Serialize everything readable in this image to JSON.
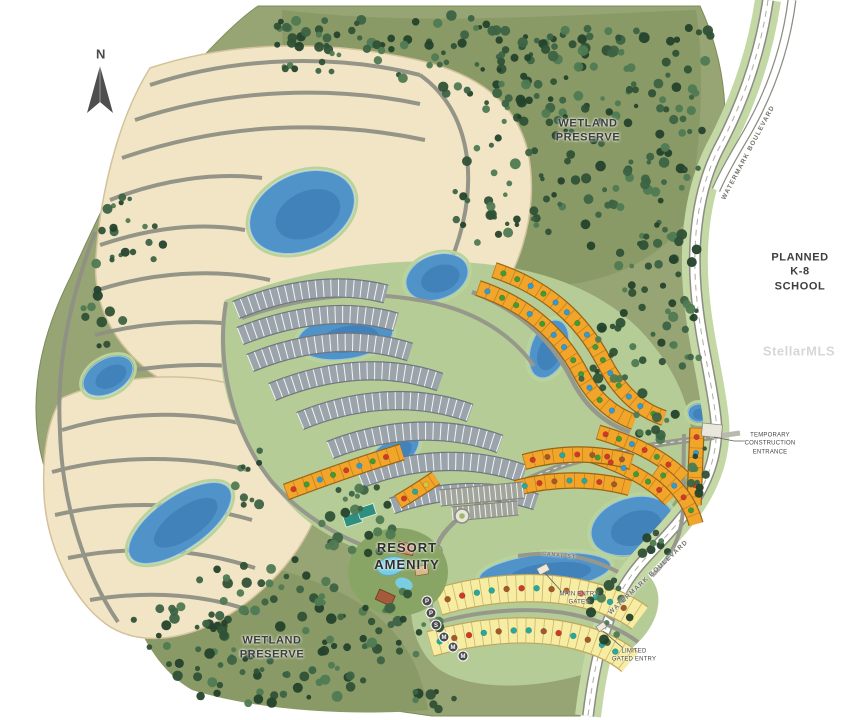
{
  "labels": {
    "compass": "N",
    "wetland_top": "WETLAND\nPRESERVE",
    "wetland_bottom": "WETLAND\nPRESERVE",
    "planned_school": "PLANNED\nK-8 SCHOOL",
    "resort_amenity": "RESORT\nAMENITY",
    "temp_construction_entrance": "TEMPORARY\nCONSTRUCTION\nENTRANCE",
    "main_entry_gates": "MAIN ENTRY\nGATES",
    "limited_gated_entry": "LIMITED\nGATED ENTRY",
    "watermark_blvd_top": "WATERMARK BOULEVARD",
    "watermark_blvd_bottom": "WATERMARK BOULEVARD",
    "canal_st": "CANAL ST.",
    "stellar_watermark": "StellarMLS"
  },
  "palette": {
    "olive": "#97a474",
    "olive_dark": "#8a9a66",
    "green_light": "#b5cc96",
    "verge": "#c3d8a4",
    "beige": "#f2e5c6",
    "beige_edge": "#d3c29b",
    "street": "#8f9184",
    "road": "#96988c",
    "road_casing": "#8c8c82",
    "road_white": "#ffffff",
    "lake": "#4f93c9",
    "lake_deep": "#2f6ea6",
    "lake_edge": "#9fc6e4",
    "shore": "#b9d49a",
    "lot_gray": "#9ba3ab",
    "lot_gray_edge": "#6f767e",
    "lot_orange": "#f2a52b",
    "lot_orange_edge": "#9a6415",
    "lot_yellow": "#f6eda2",
    "lot_yellow_edge": "#c0a55e",
    "parking": "#a2a59c",
    "parking_edge": "#85887f",
    "dot_green": "#3f9c35",
    "dot_blue": "#2e9bd6",
    "dot_red": "#cf3a28",
    "dot_teal": "#27a89e",
    "dot_brown": "#a3582a",
    "dot_yellow": "#d9c63a",
    "trees": [
      "#24422c",
      "#2f5136",
      "#3c6344",
      "#4f7a52"
    ],
    "text": "#3e3e3e"
  },
  "map": {
    "lakes": [
      {
        "cx": 302,
        "cy": 212,
        "rx": 55,
        "ry": 38,
        "rot": -25
      },
      {
        "cx": 345,
        "cy": 337,
        "rx": 48,
        "ry": 22,
        "rot": -8
      },
      {
        "cx": 108,
        "cy": 376,
        "rx": 27,
        "ry": 17,
        "rot": -30
      },
      {
        "cx": 180,
        "cy": 523,
        "rx": 60,
        "ry": 26,
        "rot": -35
      },
      {
        "cx": 392,
        "cy": 456,
        "rx": 32,
        "ry": 15,
        "rot": -38
      },
      {
        "cx": 549,
        "cy": 349,
        "rx": 18,
        "ry": 30,
        "rot": 20
      },
      {
        "cx": 632,
        "cy": 526,
        "rx": 42,
        "ry": 28,
        "rot": -18
      },
      {
        "cx": 545,
        "cy": 572,
        "rx": 66,
        "ry": 18,
        "rot": -6
      },
      {
        "cx": 699,
        "cy": 413,
        "rx": 11,
        "ry": 9,
        "rot": 0
      },
      {
        "cx": 437,
        "cy": 277,
        "rx": 32,
        "ry": 22,
        "rot": -20
      }
    ],
    "strips": [
      {
        "name": "gray-row-1",
        "d": "M 236 310 C 290 288 340 282 386 294",
        "w": 17,
        "fill": "lot_gray",
        "edge": "lot_gray_edge",
        "div": {
          "c": "road_white",
          "dash": "1 6.5",
          "op": 0.9
        }
      },
      {
        "name": "gray-row-2",
        "d": "M 240 336 C 296 314 348 308 396 322",
        "w": 17,
        "fill": "lot_gray",
        "edge": "lot_gray_edge",
        "div": {
          "c": "road_white",
          "dash": "1 6.5",
          "op": 0.9
        }
      },
      {
        "name": "gray-row-3",
        "d": "M 250 363 C 306 340 360 336 410 352",
        "w": 17,
        "fill": "lot_gray",
        "edge": "lot_gray_edge",
        "div": {
          "c": "road_white",
          "dash": "1 6.5",
          "op": 0.9
        }
      },
      {
        "name": "gray-row-4",
        "d": "M 272 392 C 330 368 388 364 440 382",
        "w": 17,
        "fill": "lot_gray",
        "edge": "lot_gray_edge",
        "div": {
          "c": "road_white",
          "dash": "1 6.5",
          "op": 0.9
        }
      },
      {
        "name": "gray-row-5",
        "d": "M 300 421 C 358 397 418 394 470 413",
        "w": 17,
        "fill": "lot_gray",
        "edge": "lot_gray_edge",
        "div": {
          "c": "road_white",
          "dash": "1 6.5",
          "op": 0.9
        }
      },
      {
        "name": "gray-row-6",
        "d": "M 330 450 C 388 427 448 425 500 444",
        "w": 17,
        "fill": "lot_gray",
        "edge": "lot_gray_edge",
        "div": {
          "c": "road_white",
          "dash": "1 6.5",
          "op": 0.9
        }
      },
      {
        "name": "gray-row-7",
        "d": "M 360 479 C 416 457 474 456 524 474",
        "w": 17,
        "fill": "lot_gray",
        "edge": "lot_gray_edge",
        "div": {
          "c": "road_white",
          "dash": "1 6.5",
          "op": 0.9
        }
      },
      {
        "name": "gray-row-8",
        "d": "M 392 506 C 442 488 492 487 536 502",
        "w": 15,
        "fill": "lot_gray",
        "edge": "lot_gray_edge",
        "div": {
          "c": "road_white",
          "dash": "1 6.5",
          "op": 0.9
        }
      },
      {
        "name": "orange-arc-outer",
        "d": "M 494 270 C 548 288 582 320 604 362 C 620 393 640 410 664 418",
        "w": 14,
        "fill": "lot_orange",
        "edge": "lot_orange_edge",
        "div": {
          "c": "lot_orange_edge",
          "dash": "0.8 9",
          "op": 0.55
        },
        "dots": {
          "spacing": 15,
          "inset": 10,
          "r": 2.8,
          "colors": [
            "dot_green",
            "dot_green",
            "dot_blue",
            "dot_green",
            "dot_blue",
            "dot_blue",
            "dot_green",
            "dot_blue"
          ]
        }
      },
      {
        "name": "orange-arc-inner",
        "d": "M 478 288 C 528 305 560 334 580 372 C 594 399 612 414 634 422",
        "w": 14,
        "fill": "lot_orange",
        "edge": "lot_orange_edge",
        "div": {
          "c": "lot_orange_edge",
          "dash": "0.8 9",
          "op": 0.55
        },
        "dots": {
          "spacing": 16,
          "inset": 10,
          "r": 2.8,
          "colors": [
            "dot_blue",
            "dot_green",
            "dot_green",
            "dot_blue",
            "dot_green",
            "dot_blue"
          ]
        }
      },
      {
        "name": "orange-right-1",
        "d": "M 598 432 C 632 442 662 456 684 478",
        "w": 13,
        "fill": "lot_orange",
        "edge": "lot_orange_edge",
        "div": {
          "c": "lot_orange_edge",
          "dash": "0.8 9",
          "op": 0.55
        },
        "dots": {
          "spacing": 14,
          "inset": 8,
          "r": 2.8,
          "colors": [
            "dot_red",
            "dot_green",
            "dot_blue",
            "dot_red",
            "dot_green"
          ]
        }
      },
      {
        "name": "orange-right-2",
        "d": "M 590 455 C 622 465 650 479 670 500",
        "w": 13,
        "fill": "lot_orange",
        "edge": "lot_orange_edge",
        "div": {
          "c": "lot_orange_edge",
          "dash": "0.8 9",
          "op": 0.55
        },
        "dots": {
          "spacing": 14,
          "inset": 8,
          "r": 2.8,
          "colors": [
            "dot_green",
            "dot_red",
            "dot_blue",
            "dot_green"
          ]
        }
      },
      {
        "name": "orange-right-col",
        "d": "M 697 428 L 694 505",
        "w": 13,
        "fill": "lot_orange",
        "edge": "lot_orange_edge",
        "div": {
          "c": "lot_orange_edge",
          "dash": "0.8 9",
          "op": 0.55
        },
        "dots": {
          "spacing": 16,
          "inset": 9,
          "r": 2.8,
          "colors": [
            "dot_red",
            "dot_blue",
            "dot_green"
          ]
        }
      },
      {
        "name": "orange-left-row",
        "d": "M 286 492 C 326 477 366 463 402 452",
        "w": 15,
        "fill": "lot_orange",
        "edge": "lot_orange_edge",
        "div": {
          "c": "lot_orange_edge",
          "dash": "0.8 9",
          "op": 0.55
        },
        "dots": {
          "spacing": 14,
          "inset": 8,
          "r": 2.8,
          "colors": [
            "dot_red",
            "dot_green",
            "dot_blue",
            "dot_green",
            "dot_red",
            "dot_blue",
            "dot_green"
          ]
        }
      },
      {
        "name": "orange-small-row",
        "d": "M 398 502 C 412 494 424 486 436 478",
        "w": 13,
        "fill": "lot_orange",
        "edge": "lot_orange_edge",
        "div": {
          "c": "lot_orange_edge",
          "dash": "0.8 9",
          "op": 0.55
        },
        "dots": {
          "spacing": 13,
          "inset": 7,
          "r": 2.8,
          "colors": [
            "dot_red",
            "dot_teal",
            "dot_yellow"
          ]
        }
      },
      {
        "name": "orange-mid-1",
        "d": "M 524 462 C 560 452 598 452 632 462",
        "w": 14,
        "fill": "lot_orange",
        "edge": "lot_orange_edge",
        "div": {
          "c": "lot_orange_edge",
          "dash": "0.8 9",
          "op": 0.55
        },
        "dots": {
          "spacing": 15,
          "inset": 9,
          "r": 2.8,
          "colors": [
            "dot_red",
            "dot_brown",
            "dot_teal",
            "dot_red",
            "dot_brown"
          ]
        }
      },
      {
        "name": "orange-mid-2",
        "d": "M 516 488 C 554 478 594 478 630 488",
        "w": 14,
        "fill": "lot_orange",
        "edge": "lot_orange_edge",
        "div": {
          "c": "lot_orange_edge",
          "dash": "0.8 9",
          "op": 0.55
        },
        "dots": {
          "spacing": 15,
          "inset": 9,
          "r": 2.8,
          "colors": [
            "dot_teal",
            "dot_red",
            "dot_brown",
            "dot_teal"
          ]
        }
      },
      {
        "name": "orange-lake-east",
        "d": "M 656 470 C 676 484 690 502 696 524",
        "w": 13,
        "fill": "lot_orange",
        "edge": "lot_orange_edge",
        "div": {
          "c": "lot_orange_edge",
          "dash": "0.8 9",
          "op": 0.55
        },
        "dots": {
          "spacing": 15,
          "inset": 9,
          "r": 2.8,
          "colors": [
            "dot_green",
            "dot_blue",
            "dot_red"
          ]
        }
      },
      {
        "name": "yellow-row-1",
        "d": "M 438 602 C 480 589 530 584 574 592 C 604 598 624 606 640 618",
        "w": 26,
        "fill": "lot_yellow",
        "edge": "lot_yellow_edge",
        "div": {
          "c": "lot_yellow_edge",
          "dash": "0.8 8",
          "op": 0.8
        },
        "dots": {
          "spacing": 15,
          "inset": 10,
          "r": 3,
          "colors": [
            "dot_brown",
            "dot_red",
            "dot_teal",
            "dot_teal",
            "dot_brown",
            "dot_red",
            "dot_teal",
            "dot_brown"
          ]
        }
      },
      {
        "name": "yellow-row-2",
        "d": "M 430 644 C 472 632 522 626 564 634 C 596 640 616 650 630 662",
        "w": 24,
        "fill": "lot_yellow",
        "edge": "lot_yellow_edge",
        "div": {
          "c": "lot_yellow_edge",
          "dash": "0.8 8",
          "op": 0.8
        },
        "dots": {
          "spacing": 15,
          "inset": 10,
          "r": 3,
          "colors": [
            "dot_teal",
            "dot_brown",
            "dot_red",
            "dot_teal",
            "dot_brown",
            "dot_teal"
          ]
        }
      },
      {
        "name": "parking-row-1",
        "d": "M 440 498 L 524 490",
        "w": 15,
        "fill": "parking",
        "edge": "parking_edge",
        "div": {
          "c": "road_white",
          "dash": "1 4.5",
          "op": 0.85
        }
      },
      {
        "name": "parking-row-2",
        "d": "M 452 514 L 518 508",
        "w": 13,
        "fill": "parking",
        "edge": "parking_edge",
        "div": {
          "c": "road_white",
          "dash": "1 4.5",
          "op": 0.85
        }
      }
    ],
    "markers": [
      {
        "x": 427,
        "y": 601,
        "t": "P"
      },
      {
        "x": 431,
        "y": 613,
        "t": "P"
      },
      {
        "x": 436,
        "y": 625,
        "t": "S"
      },
      {
        "x": 444,
        "y": 637,
        "t": "M"
      },
      {
        "x": 453,
        "y": 647,
        "t": "M"
      },
      {
        "x": 463,
        "y": 656,
        "t": "M"
      }
    ],
    "tree_clusters": [
      [
        320,
        35,
        70,
        22,
        26
      ],
      [
        450,
        55,
        90,
        40,
        48
      ],
      [
        560,
        80,
        80,
        45,
        42
      ],
      [
        650,
        140,
        58,
        60,
        40
      ],
      [
        600,
        210,
        70,
        45,
        30
      ],
      [
        660,
        280,
        48,
        58,
        30
      ],
      [
        620,
        360,
        45,
        40,
        22
      ],
      [
        682,
        330,
        26,
        38,
        14
      ],
      [
        130,
        240,
        40,
        45,
        20
      ],
      [
        103,
        320,
        22,
        35,
        10
      ],
      [
        358,
        520,
        38,
        45,
        25
      ],
      [
        398,
        625,
        42,
        40,
        22
      ],
      [
        270,
        600,
        80,
        45,
        40
      ],
      [
        180,
        640,
        58,
        38,
        28
      ],
      [
        330,
        665,
        58,
        35,
        26
      ],
      [
        240,
        680,
        68,
        28,
        20
      ],
      [
        520,
        140,
        60,
        50,
        30
      ],
      [
        600,
        40,
        60,
        30,
        20
      ],
      [
        692,
        60,
        26,
        40,
        14
      ],
      [
        655,
        420,
        22,
        22,
        10
      ],
      [
        432,
        700,
        28,
        12,
        8
      ],
      [
        300,
        60,
        40,
        20,
        10
      ],
      [
        250,
        470,
        18,
        40,
        10
      ],
      [
        608,
        612,
        22,
        38,
        14
      ],
      [
        655,
        545,
        14,
        22,
        8
      ],
      [
        700,
        470,
        13,
        28,
        8
      ],
      [
        488,
        210,
        40,
        35,
        18
      ]
    ]
  }
}
